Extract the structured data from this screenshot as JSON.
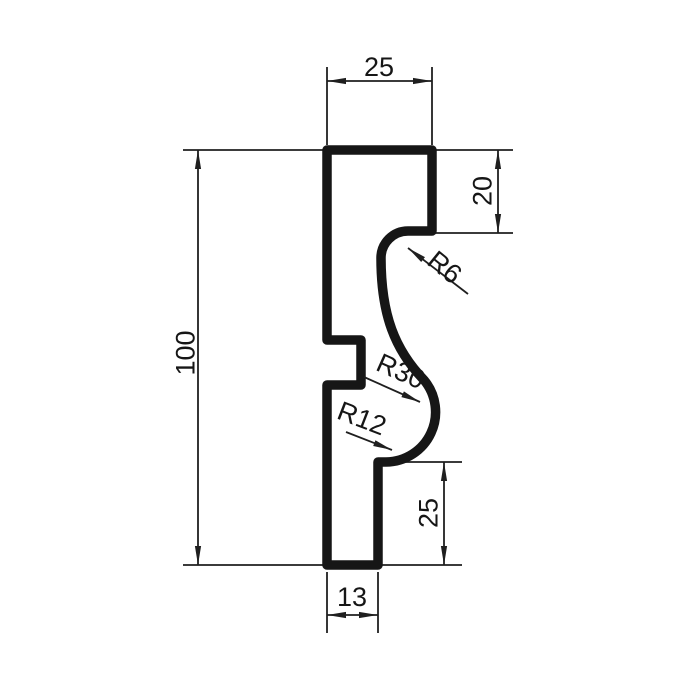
{
  "drawing": {
    "dimensions": {
      "top_width": "25",
      "upper_right_height": "20",
      "overall_height": "100",
      "lower_right_height": "25",
      "bottom_width": "13"
    },
    "radii": {
      "upper": "R6",
      "middle": "R30",
      "lower": "R12"
    },
    "colors": {
      "ink": "#1a1a1a"
    }
  }
}
